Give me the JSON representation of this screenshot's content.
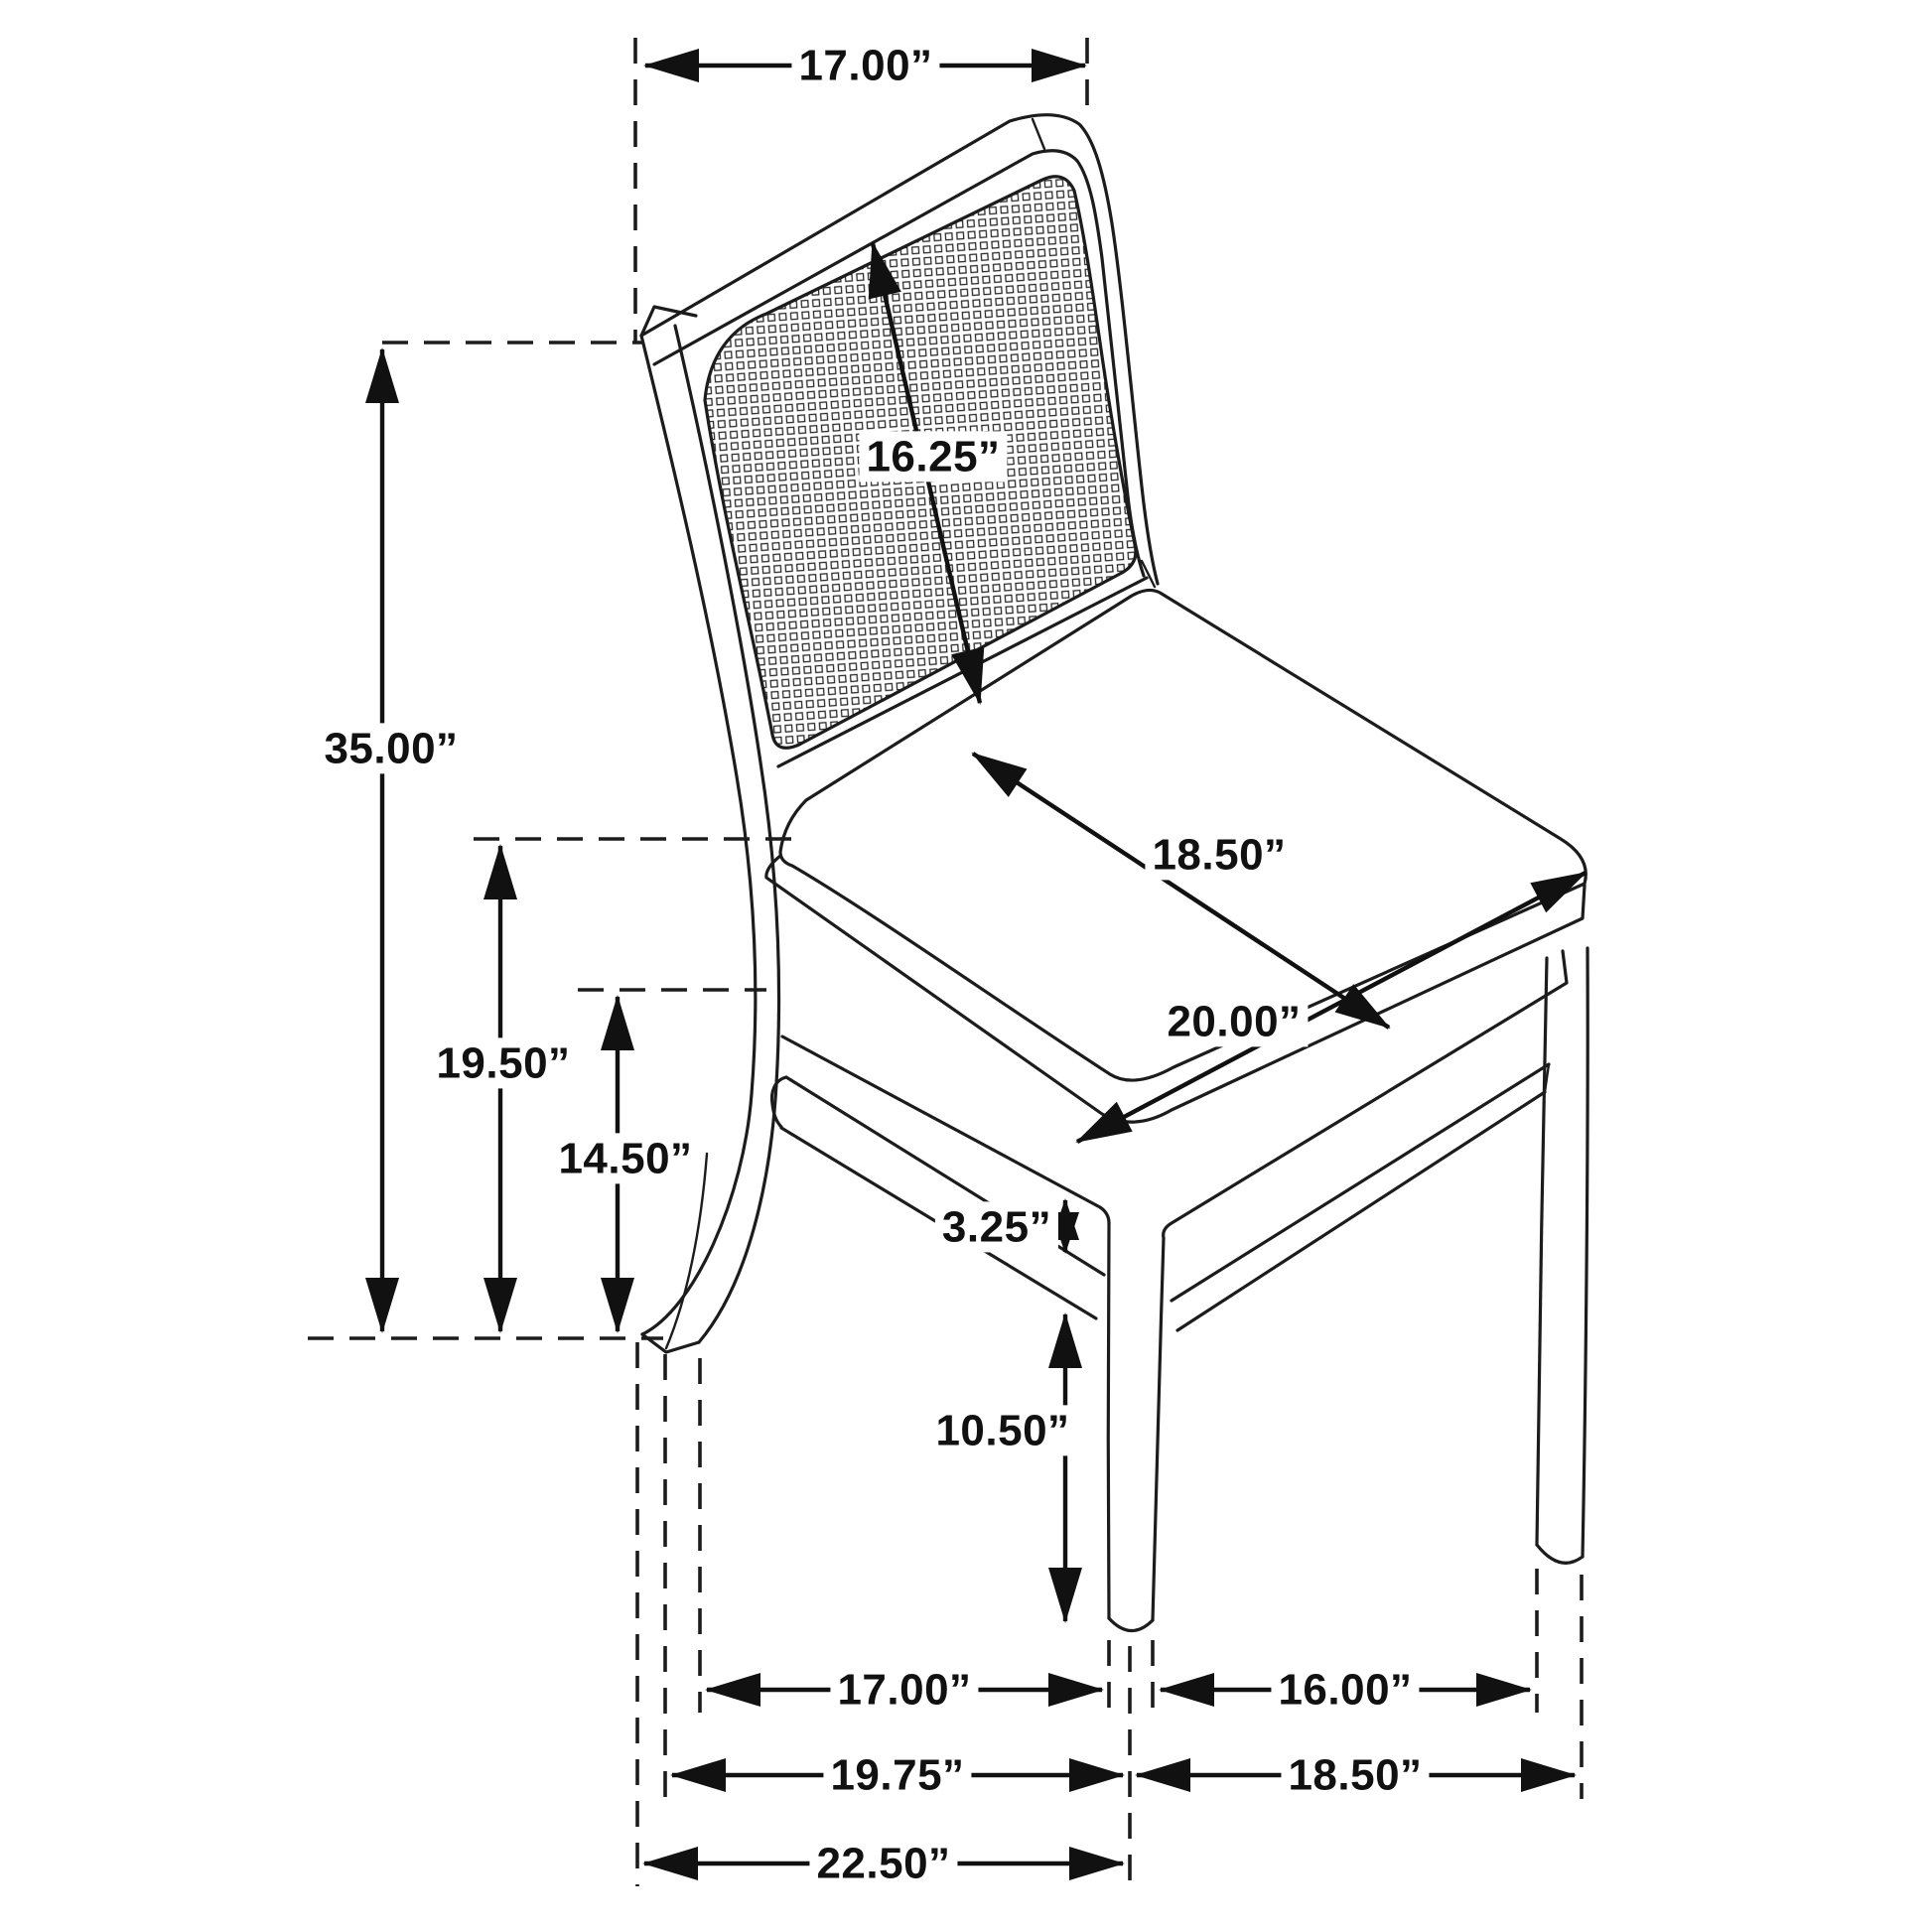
{
  "figure": {
    "kind": "furniture dimension line-drawing",
    "subject": "side dining chair with cane webbed back, upholstered seat, tapered legs and side stretchers",
    "unit": "inches",
    "ink_color": "#1c1c1c",
    "background_color": "#ffffff"
  },
  "dimensions": {
    "back_width": {
      "name": "back width at top of backrest",
      "label": "17.00”",
      "value": 17.0
    },
    "back_height": {
      "name": "cane back panel height (diagonal)",
      "label": "16.25”",
      "value": 16.25
    },
    "overall_height": {
      "name": "overall chair height",
      "label": "35.00”",
      "value": 35.0
    },
    "seat_height": {
      "name": "floor to top of seat",
      "label": "19.50”",
      "value": 19.5
    },
    "apron_height": {
      "name": "floor to bottom of seat frame",
      "label": "14.50”",
      "value": 14.5
    },
    "seat_depth": {
      "name": "seat cushion depth (diagonal)",
      "label": "18.50”",
      "value": 18.5
    },
    "seat_width": {
      "name": "seat cushion width (diagonal)",
      "label": "20.00”",
      "value": 20.0
    },
    "rail_gap": {
      "name": "gap between seat frame and stretcher",
      "label": "3.25”",
      "value": 3.25
    },
    "stretcher_height": {
      "name": "floor to side stretcher at front leg",
      "label": "10.50”",
      "value": 10.5
    },
    "leg_span_depth_inner": {
      "name": "front to rear leg spacing (inner)",
      "label": "17.00”",
      "value": 17.0
    },
    "leg_span_width_inner": {
      "name": "front to side rear leg spacing (inner)",
      "label": "16.00”",
      "value": 16.0
    },
    "leg_span_depth_outer": {
      "name": "front leg center to rear leg (outer)",
      "label": "19.75”",
      "value": 19.75
    },
    "leg_span_width_outer": {
      "name": "front leg center to side rear leg (outer)",
      "label": "18.50”",
      "value": 18.5
    },
    "overall_depth": {
      "name": "overall depth of chair",
      "label": "22.50”",
      "value": 22.5
    }
  }
}
